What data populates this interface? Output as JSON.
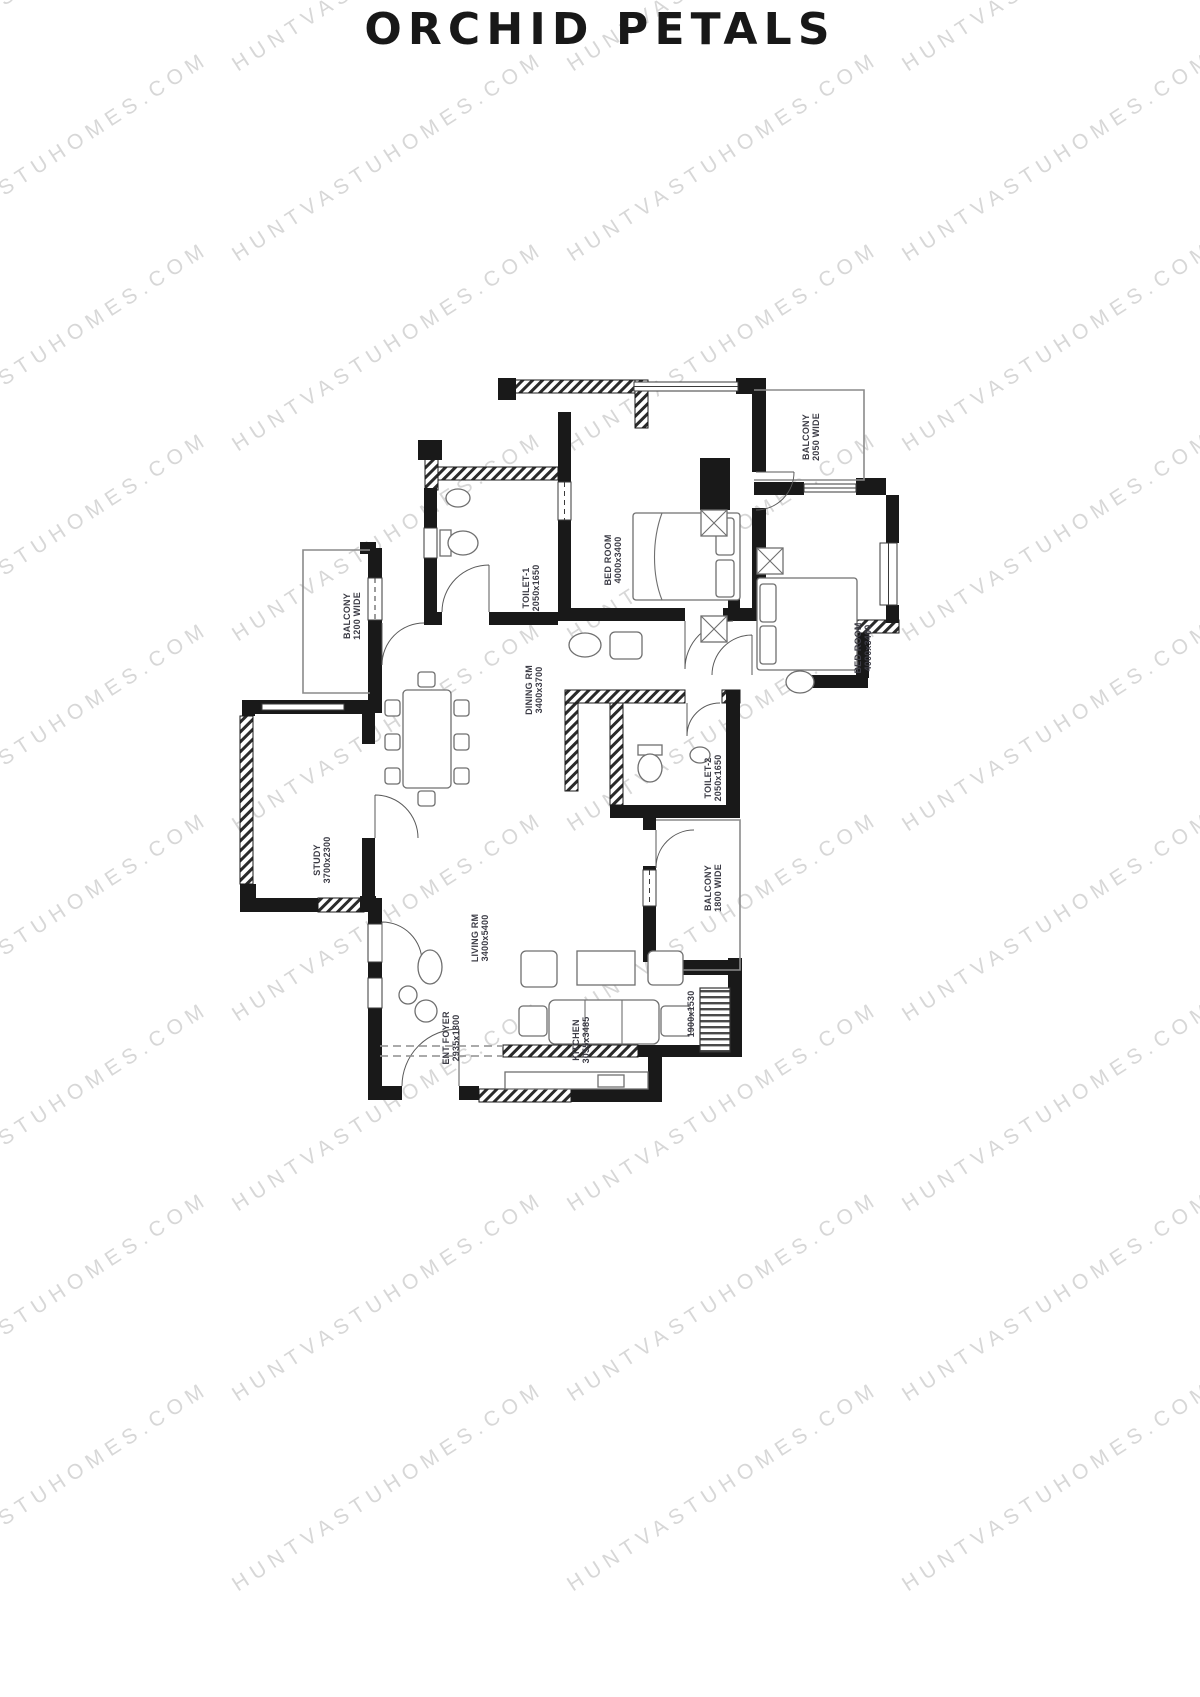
{
  "page": {
    "title": "ORCHID PETALS"
  },
  "watermark": {
    "text": "HUNTVASTUHOMES.COM",
    "color": "#d7d7d7"
  },
  "floor_plan": {
    "label_color": "#3c3c46",
    "rooms": [
      {
        "id": "bedroom-1",
        "name": "BED ROOM",
        "dims": "4000x3400"
      },
      {
        "id": "balcony-top",
        "name": "BALCONY",
        "dims": "2050 WIDE"
      },
      {
        "id": "toilet-1",
        "name": "TOILET-1",
        "dims": "2050x1650"
      },
      {
        "id": "bedroom-2",
        "name": "BED ROOM",
        "dims": "4000x3400"
      },
      {
        "id": "balcony-left",
        "name": "BALCONY",
        "dims": "1200 WIDE"
      },
      {
        "id": "dining",
        "name": "DINING RM",
        "dims": "3400x3700"
      },
      {
        "id": "toilet-2",
        "name": "TOILET-2",
        "dims": "2050x1650"
      },
      {
        "id": "study",
        "name": "STUDY",
        "dims": "3700x2300"
      },
      {
        "id": "living",
        "name": "LIVING RM",
        "dims": "3400x5400"
      },
      {
        "id": "balcony-right",
        "name": "BALCONY",
        "dims": "1800 WIDE"
      },
      {
        "id": "ent-foyer",
        "name": "ENT FOYER",
        "dims": "2935x1800"
      },
      {
        "id": "kitchen",
        "name": "KITCHEN",
        "dims": "3055x3485"
      },
      {
        "id": "utility",
        "name": "",
        "dims": "1900x1530"
      }
    ]
  }
}
